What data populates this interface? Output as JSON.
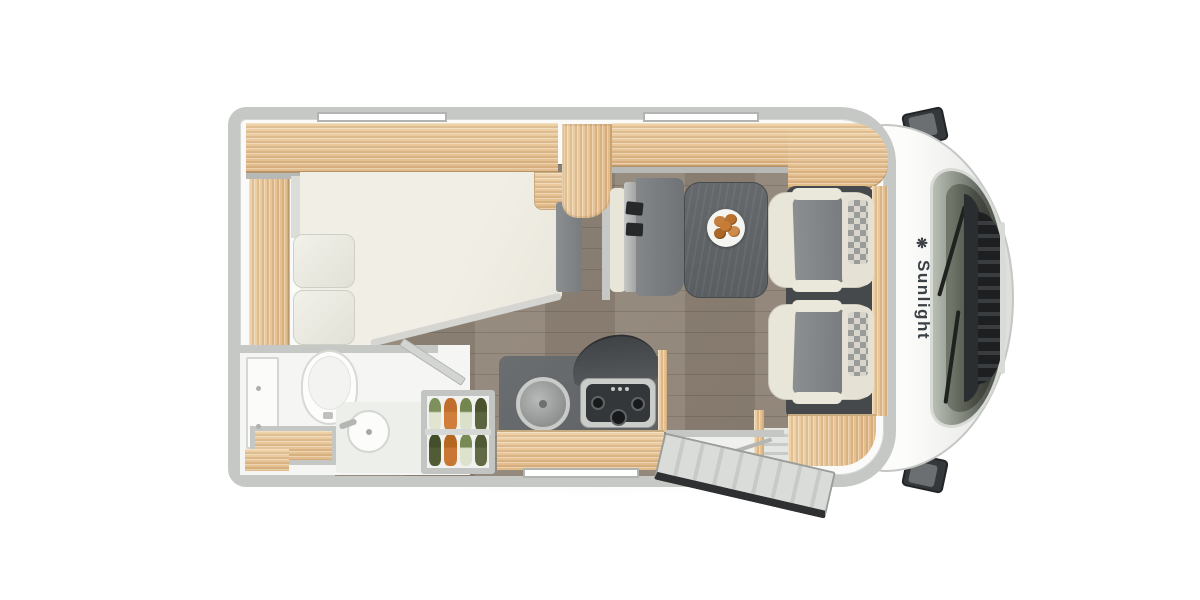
{
  "branding": {
    "logo_text": "Sunlight",
    "logo_icon_glyph": "❋"
  },
  "palette": {
    "bg": "#ffffff",
    "wall": "#c6c8c5",
    "wall_edge": "#b2b4b1",
    "interior": "#fafbf9",
    "wood_light": "#eed2a9",
    "wood_dark": "#e2ba89",
    "wood_edge": "#c9ab80",
    "floor": "#8c8073",
    "counter_dark": "#5e6264",
    "table_dark": "#5a5e61",
    "bench_gray": "#7c8082",
    "cream": "#e8e5d9",
    "seat_gray": "#82868a",
    "mat_dark": "#45494b",
    "glass": "#4a4f48",
    "cab_white": "#f3f4f2",
    "mirror_dark": "#35383b",
    "brand_text": "#3b4045"
  },
  "pantry": {
    "items": [
      {
        "name": "leek",
        "body": "#e0e4d0",
        "top": "#7e905b"
      },
      {
        "name": "carrot",
        "body": "#cf7e3b",
        "top": "#c06f2e"
      },
      {
        "name": "leek",
        "body": "#dbe0ca",
        "top": "#74864f"
      },
      {
        "name": "broccoli",
        "body": "#5a6540",
        "top": "#49542f"
      },
      {
        "name": "broccoli",
        "body": "#515c37",
        "top": "#434e2b"
      },
      {
        "name": "carrot",
        "body": "#c97734",
        "top": "#b5661f"
      },
      {
        "name": "leek",
        "body": "#dde2cc",
        "top": "#788a53"
      },
      {
        "name": "broccoli",
        "body": "#606b45",
        "top": "#4f5a34"
      }
    ]
  },
  "dinette": {
    "plate_food_colors": [
      "#c5803f",
      "#b9712f",
      "#d08b4a",
      "#ab6628",
      "#c67b37"
    ]
  }
}
